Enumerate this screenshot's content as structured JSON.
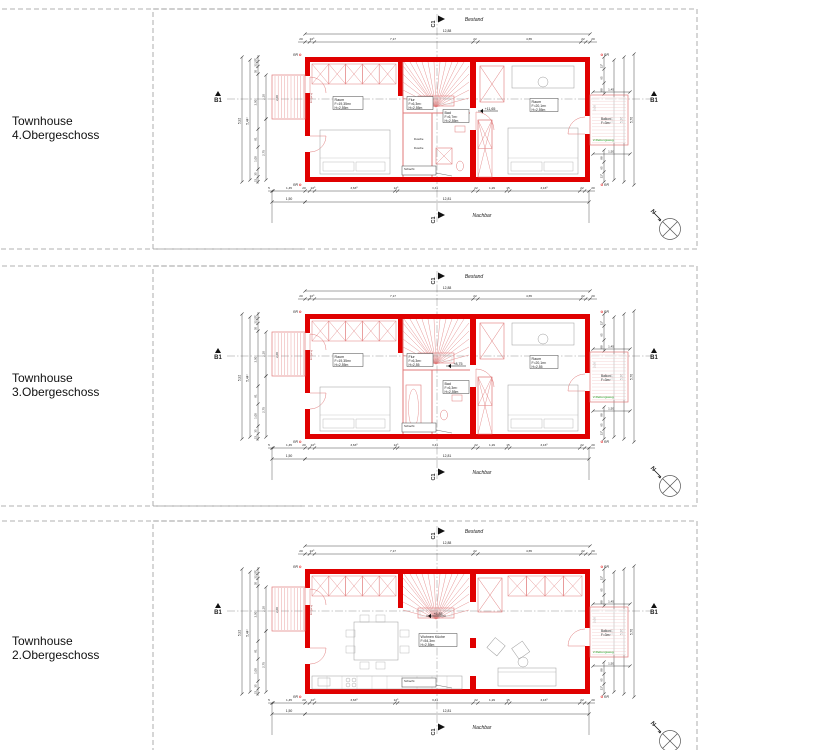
{
  "colors": {
    "wall_red": "#e00000",
    "line_red": "#e07a7a",
    "escape_green": "#1e9e1e",
    "dim_gray": "#555555"
  },
  "labels": {
    "bestand": "Bestand",
    "nachbar": "Nachbar",
    "section_c": "C1",
    "section_b": "B1",
    "rr": "RR",
    "north": "N",
    "balkon_name": "Balkon",
    "balkon_area": "F=3m²",
    "rettungsweg": "2.Rettungsweg",
    "eingang": "Eingang",
    "schacht": "Schacht",
    "dusche": "Dusche"
  },
  "dims": {
    "top_total": "12,88",
    "top_segments": [
      "20",
      "22⁵",
      "7,17",
      "22",
      "4,65",
      "22",
      "20"
    ],
    "bottom_segments": [
      "5",
      "1,45",
      "20",
      "22⁵",
      "3,63⁵",
      "12⁵",
      "3,41",
      "22",
      "1,29",
      "15",
      "3,16⁵",
      "22",
      "20"
    ],
    "bottom_left": "1,50",
    "bottom_total": "12,81",
    "left_total_outer": "5,92",
    "left_total_inner": "5,44⁵",
    "left_segments": [
      "20⁵",
      "22",
      "35",
      "2,50",
      "81",
      "1,00",
      "35",
      "22"
    ],
    "left_inner": [
      "2,10",
      "2,75"
    ],
    "left_balcony": "2,00",
    "right_top": [
      "22⁵",
      "65",
      "88"
    ],
    "right_bottom": [
      "88",
      "65",
      "22⁵"
    ],
    "right_balcony_w": "1,45",
    "right_balcony_h": "2,00",
    "right_mid": "1,86",
    "right_total_inner": "5,36",
    "right_total_outer": "5,70",
    "right_below_balcony": "1,50"
  },
  "panels": [
    {
      "title": "Townhouse 4.Obergeschoss",
      "level": "+11,65",
      "rooms": {
        "left": {
          "name": "Raum",
          "area": "F=19,35m²",
          "height": "H=2,55m"
        },
        "flur": {
          "name": "Flur",
          "area": "F=6,3m²",
          "height": "H=2,55m"
        },
        "bad": {
          "name": "Bad",
          "area": "F=6,7m²",
          "height": "H=2,55m"
        },
        "right": {
          "name": "Raum",
          "area": "F=20,1m²",
          "height": "H=2,55m"
        }
      }
    },
    {
      "title": "Townhouse 3.Obergeschoss",
      "level": "+8,75",
      "rooms": {
        "left": {
          "name": "Raum",
          "area": "F=19,35m²",
          "height": "H=2,55m"
        },
        "flur": {
          "name": "Flur",
          "area": "F=6,3m²",
          "height": "H=2,55"
        },
        "bad": {
          "name": "Bad",
          "area": "F=6,3m²",
          "height": "H=2,55m"
        },
        "right": {
          "name": "Raum",
          "area": "F=20,1m²",
          "height": "H=2,55"
        }
      }
    },
    {
      "title": "Townhouse 2.Obergeschoss",
      "level": "+5,85",
      "rooms": {
        "main": {
          "name": "Wohnen Küche",
          "area": "F=54,3m²",
          "height": "H=2,55m"
        }
      }
    }
  ]
}
